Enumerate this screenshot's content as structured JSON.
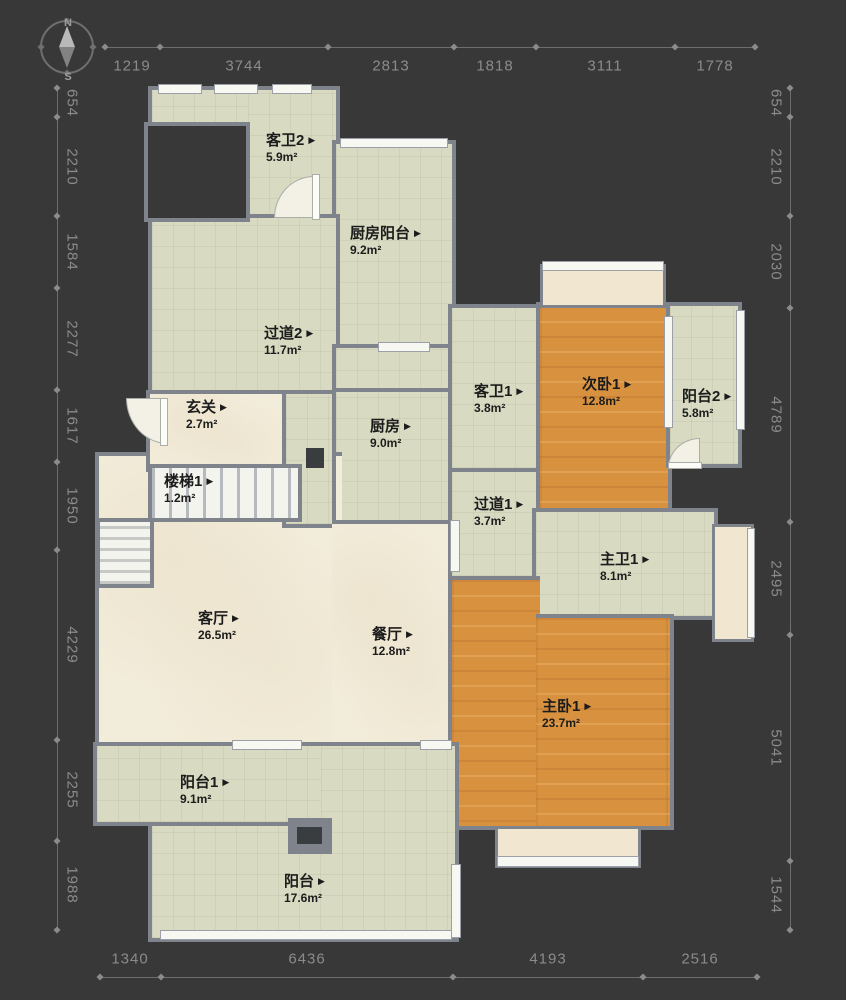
{
  "ui": {
    "marker": "▶"
  },
  "compass": {
    "north": "N",
    "south": "S"
  },
  "rulers": {
    "top": [
      "1219",
      "3744",
      "2813",
      "1818",
      "3111",
      "1778"
    ],
    "bottom": [
      "1340",
      "6436",
      "4193",
      "2516"
    ],
    "left": [
      "654",
      "2210",
      "1584",
      "2277",
      "1617",
      "1950",
      "4229",
      "2255",
      "1988"
    ],
    "right": [
      "654",
      "2210",
      "2030",
      "4789",
      "2495",
      "5041",
      "1544"
    ]
  },
  "rooms": [
    {
      "name": "客卫2",
      "area": "5.9m²"
    },
    {
      "name": "厨房阳台",
      "area": "9.2m²"
    },
    {
      "name": "过道2",
      "area": "11.7m²"
    },
    {
      "name": "玄关",
      "area": "2.7m²"
    },
    {
      "name": "楼梯1",
      "area": "1.2m²"
    },
    {
      "name": "厨房",
      "area": "9.0m²"
    },
    {
      "name": "客卫1",
      "area": "3.8m²"
    },
    {
      "name": "次卧1",
      "area": "12.8m²"
    },
    {
      "name": "阳台2",
      "area": "5.8m²"
    },
    {
      "name": "过道1",
      "area": "3.7m²"
    },
    {
      "name": "主卫1",
      "area": "8.1m²"
    },
    {
      "name": "客厅",
      "area": "26.5m²"
    },
    {
      "name": "餐厅",
      "area": "12.8m²"
    },
    {
      "name": "主卧1",
      "area": "23.7m²"
    },
    {
      "name": "阳台1",
      "area": "9.1m²"
    },
    {
      "name": "阳台",
      "area": "17.6m²"
    }
  ],
  "colors": {
    "background": "#383838",
    "wall": "#7e838c",
    "floor_tile": "#d8dbc2",
    "floor_marble": "#f2ecda",
    "floor_wood": "#d8913f",
    "bay_window": "#f1e7d1",
    "dim_text": "#8b8b8b"
  }
}
